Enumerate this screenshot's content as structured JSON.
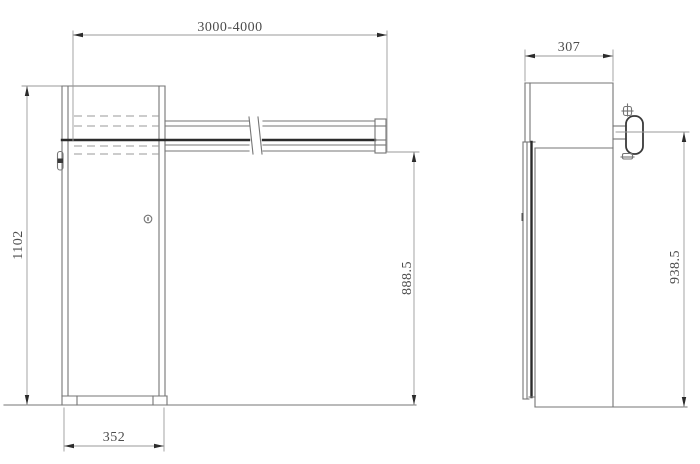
{
  "drawing": {
    "type": "technical-drawing",
    "subject": "boom-barrier-gate-dimension-drawing",
    "views": {
      "front": {
        "dim_boom_length": "3000-4000",
        "dim_total_height": "1102",
        "dim_boom_axis_height": "888.5",
        "dim_cabinet_width": "352"
      },
      "side": {
        "dim_cabinet_depth": "307",
        "dim_bracket_center_height": "938.5"
      }
    },
    "colors": {
      "background": "#ffffff",
      "line": "#757575",
      "line_dark": "#2b2b2b",
      "line_light": "#9a9a9a",
      "text": "#4d4d4d"
    }
  }
}
